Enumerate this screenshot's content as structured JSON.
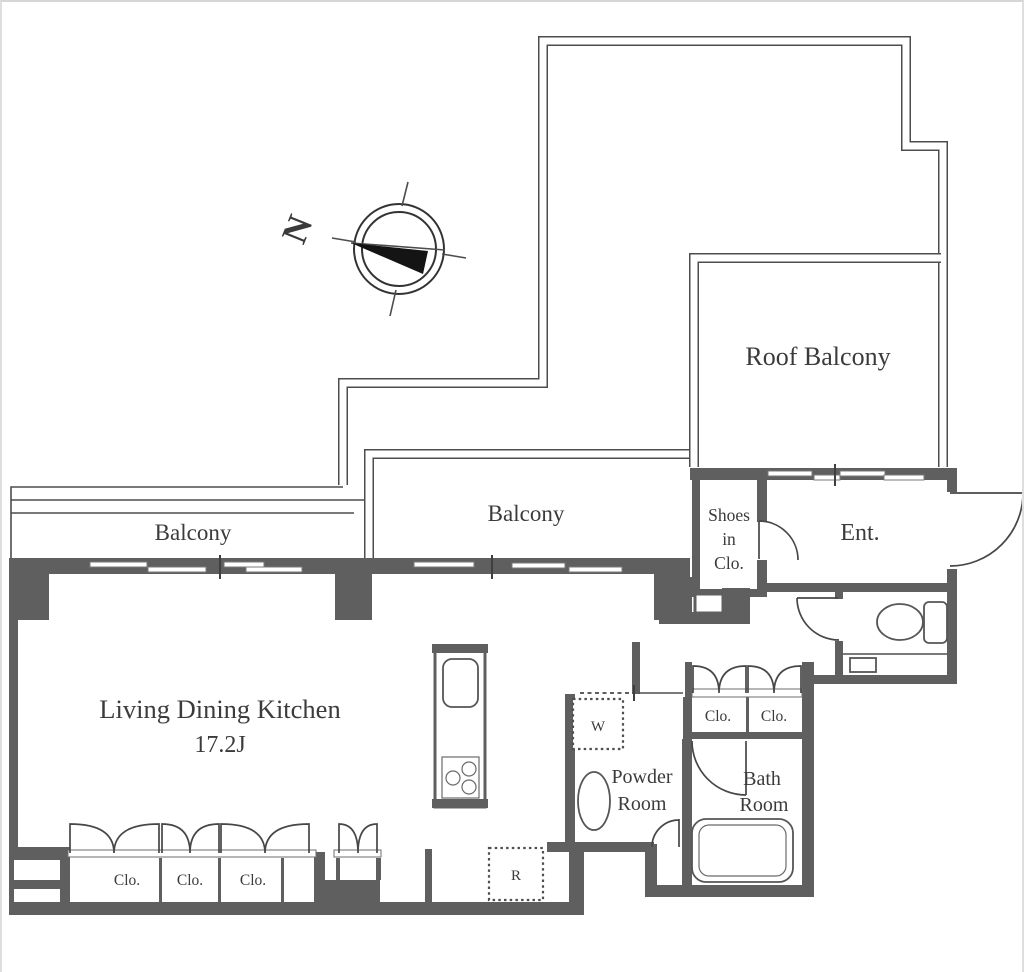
{
  "labels": {
    "north": "N",
    "roof_balcony": "Roof Balcony",
    "balcony_left": "Balcony",
    "balcony_center": "Balcony",
    "shoes_line1": "Shoes",
    "shoes_line2": "in",
    "shoes_line3": "Clo.",
    "entrance": "Ent.",
    "ldk": "Living Dining Kitchen",
    "ldk_size": "17.2J",
    "powder_line1": "Powder",
    "powder_line2": "Room",
    "bath_line1": "Bath",
    "bath_line2": "Room",
    "hall_closet_1": "Clo.",
    "hall_closet_2": "Clo.",
    "ldk_closet_1": "Clo.",
    "ldk_closet_2": "Clo.",
    "ldk_closet_3": "Clo.",
    "washing_machine": "W",
    "refrigerator": "R"
  },
  "colors": {
    "wall": "#5f5f5f",
    "line": "#4d4d4d",
    "text": "#3b3b3b",
    "background": "#ffffff"
  }
}
